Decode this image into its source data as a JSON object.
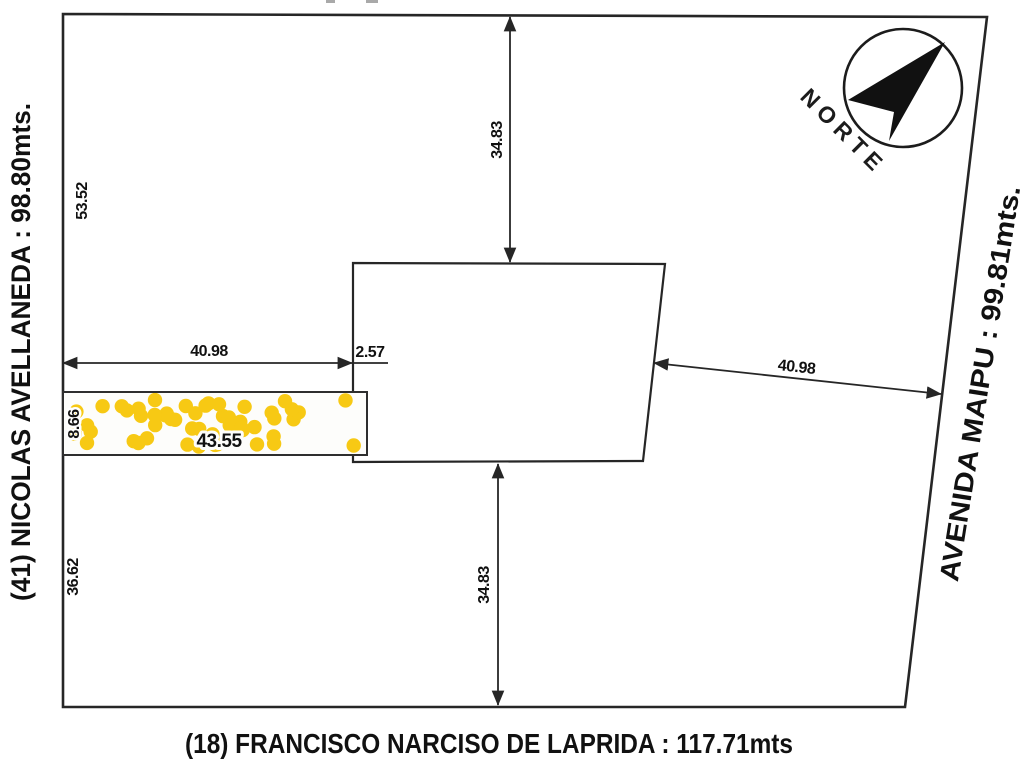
{
  "streets": {
    "left": {
      "label": "(41) NICOLAS AVELLANEDA : 98.80mts."
    },
    "right": {
      "label": "AVENIDA MAIPU : 99.81mts."
    },
    "bottom": {
      "label": "(18) FRANCISCO NARCISO DE LAPRIDA : 117.71mts"
    }
  },
  "compass": {
    "label": "NORTE"
  },
  "dimensions": {
    "left_upper_segment": "53.52",
    "left_lower_segment": "36.62",
    "top_depth": "34.83",
    "bottom_depth": "34.83",
    "strip_top_width": "40.98",
    "gap_width": "2.57",
    "right_width": "40.98",
    "strip_length": "43.55",
    "strip_height": "8.66"
  },
  "colors": {
    "line": "#262626",
    "hatch_dot": "#F7C914",
    "background": "#ffffff"
  }
}
